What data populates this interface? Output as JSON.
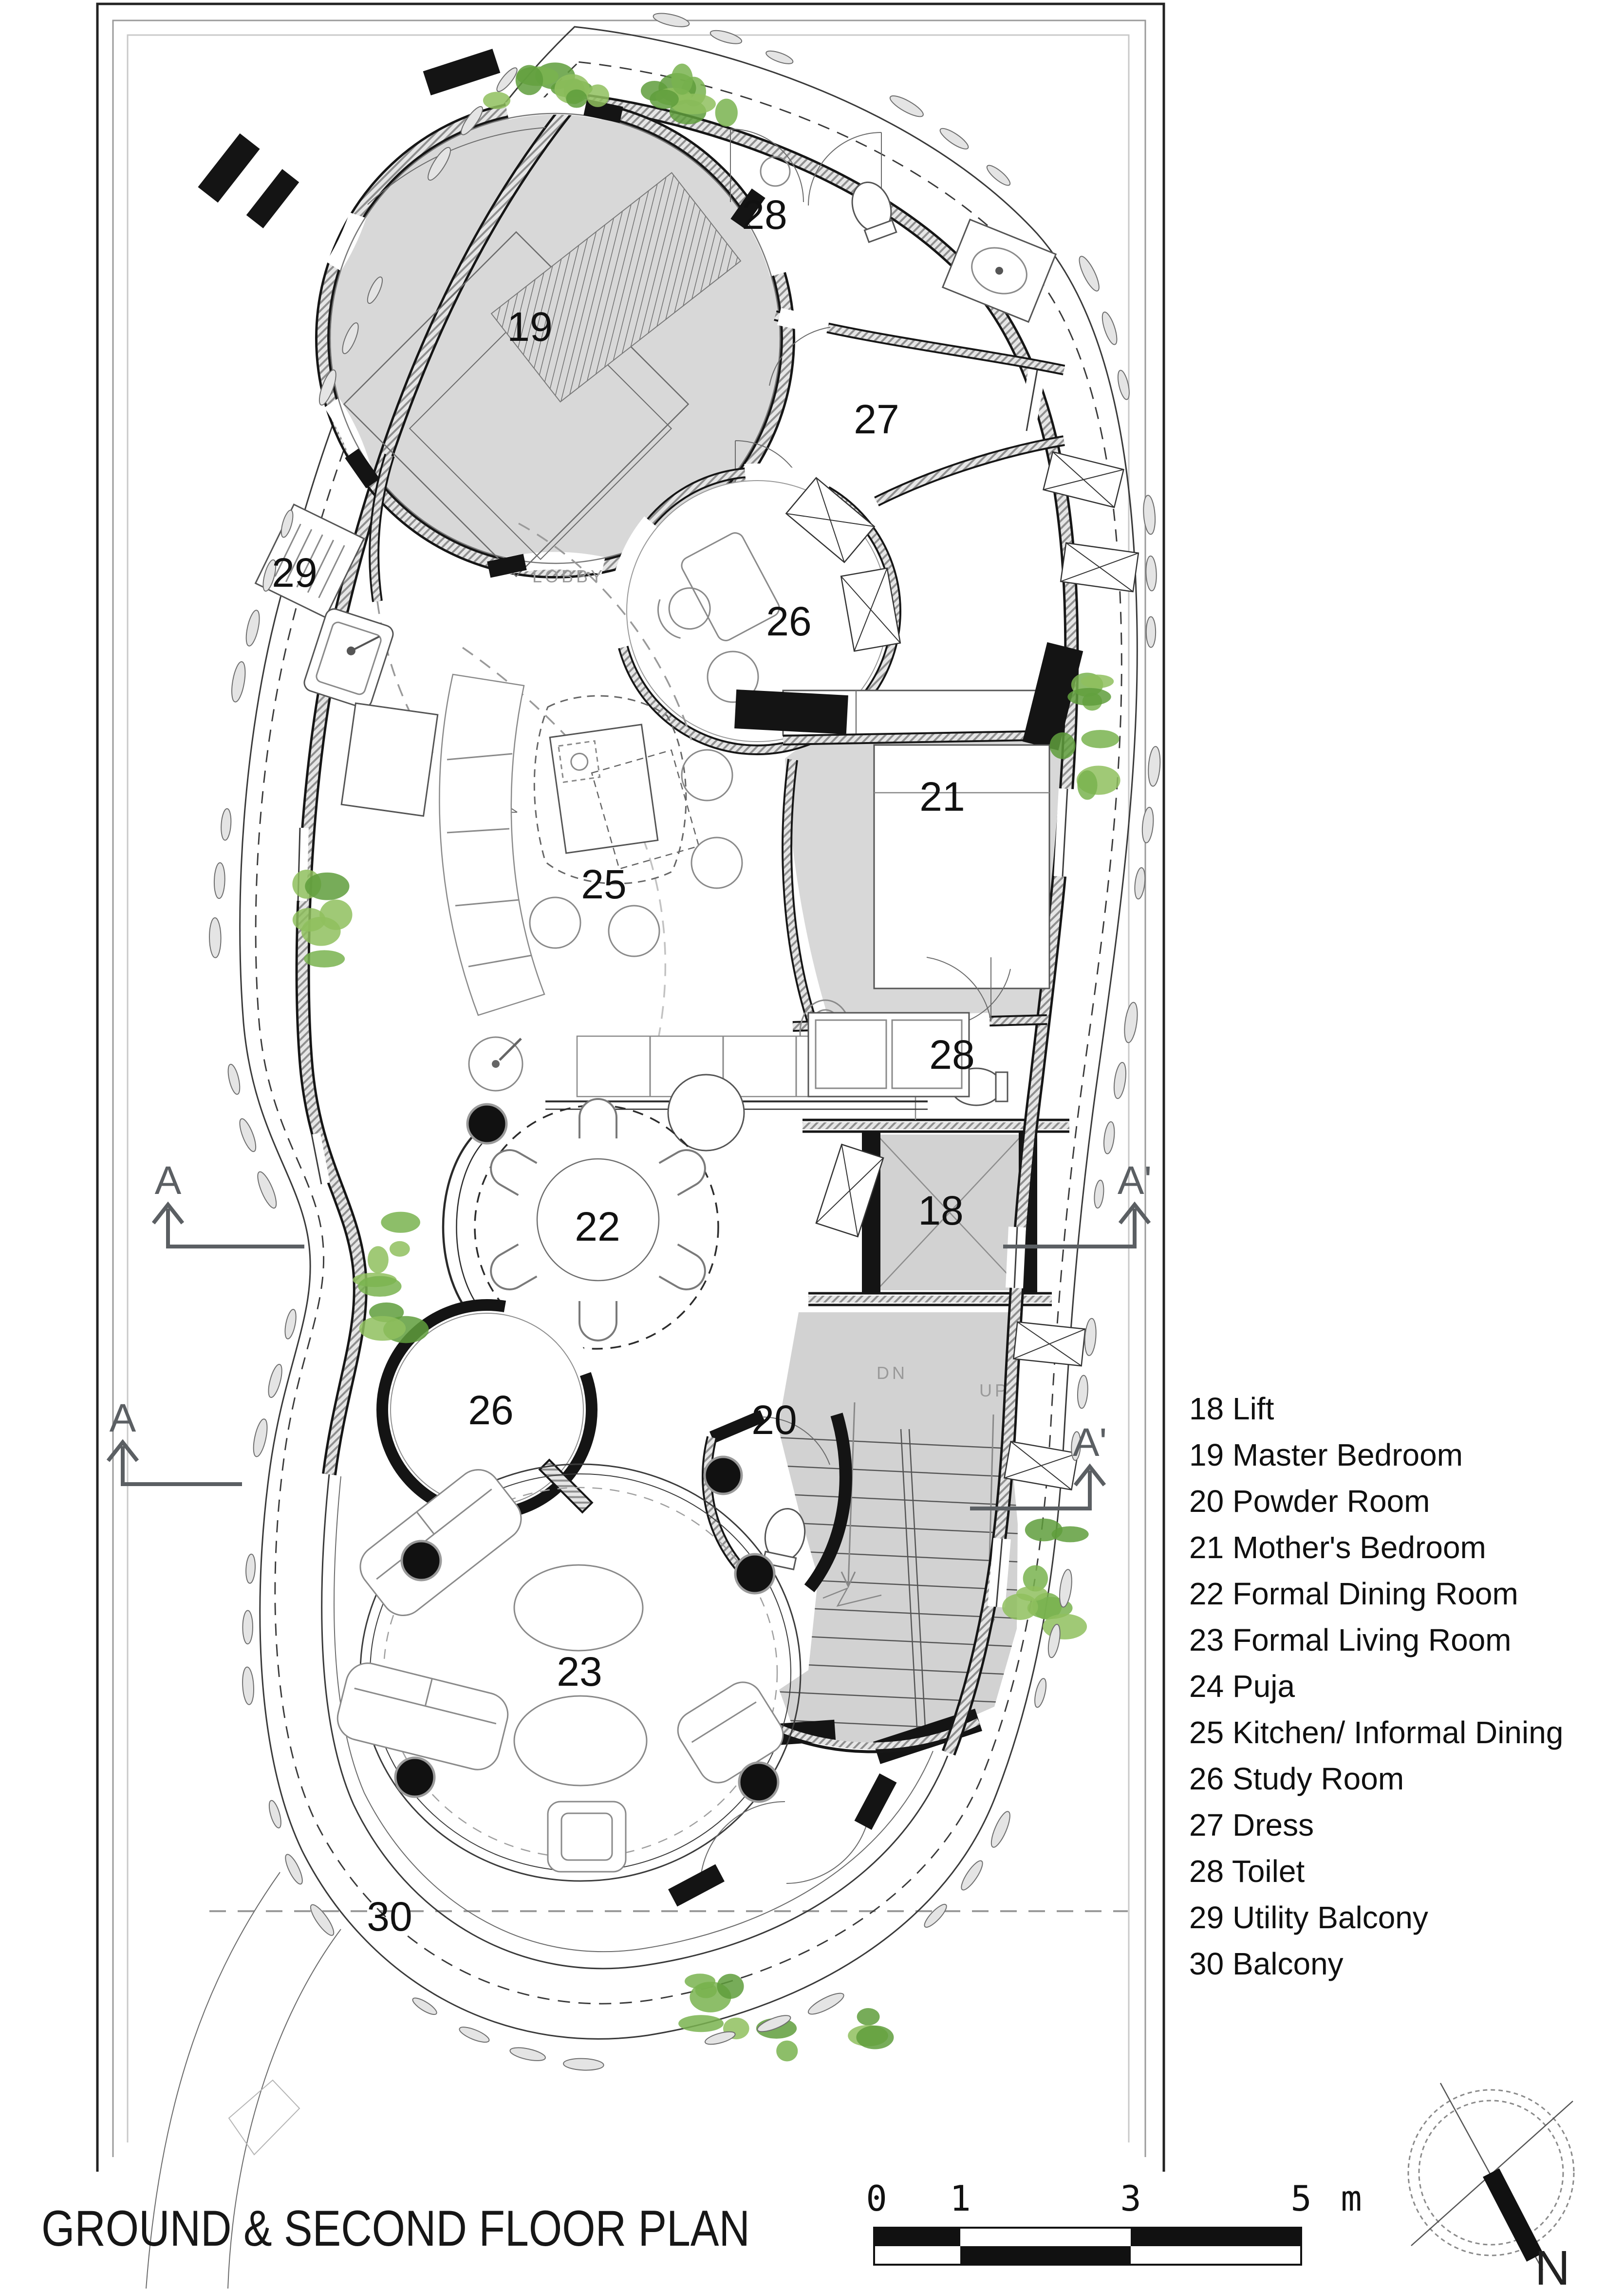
{
  "title_block": {
    "title": "GROUND & SECOND FLOOR PLAN"
  },
  "plan": {
    "room_labels": [
      "19",
      "28",
      "27",
      "29",
      "26",
      "21",
      "25",
      "28",
      "22",
      "18",
      "26",
      "20",
      "23",
      "30"
    ],
    "lobby_label": "LOBBY",
    "stair_down_label": "DN",
    "stair_up_label": "UP",
    "section_markers": [
      "A",
      "A'",
      "A",
      "A'"
    ]
  },
  "legend": {
    "items": [
      {
        "number": "18",
        "name": "Lift"
      },
      {
        "number": "19",
        "name": "Master Bedroom"
      },
      {
        "number": "20",
        "name": "Powder Room"
      },
      {
        "number": "21",
        "name": "Mother's Bedroom"
      },
      {
        "number": "22",
        "name": "Formal Dining Room"
      },
      {
        "number": "23",
        "name": "Formal Living Room"
      },
      {
        "number": "24",
        "name": "Puja"
      },
      {
        "number": "25",
        "name": "Kitchen/ Informal Dining"
      },
      {
        "number": "26",
        "name": "Study Room"
      },
      {
        "number": "27",
        "name": "Dress"
      },
      {
        "number": "28",
        "name": "Toilet"
      },
      {
        "number": "29",
        "name": "Utility Balcony"
      },
      {
        "number": "30",
        "name": "Balcony"
      }
    ]
  },
  "scale_bar": {
    "tick_labels": [
      "0",
      "1",
      "3",
      "5"
    ],
    "unit_label": "m"
  },
  "compass": {
    "north_label": "N"
  },
  "colors": {
    "room_fill": "#d8d8d8",
    "stair_fill": "#d2d2d2",
    "marker_gray": "#5b5f63",
    "plant_palette": [
      "#79b34f",
      "#5f9e3c",
      "#8fc05e"
    ]
  }
}
